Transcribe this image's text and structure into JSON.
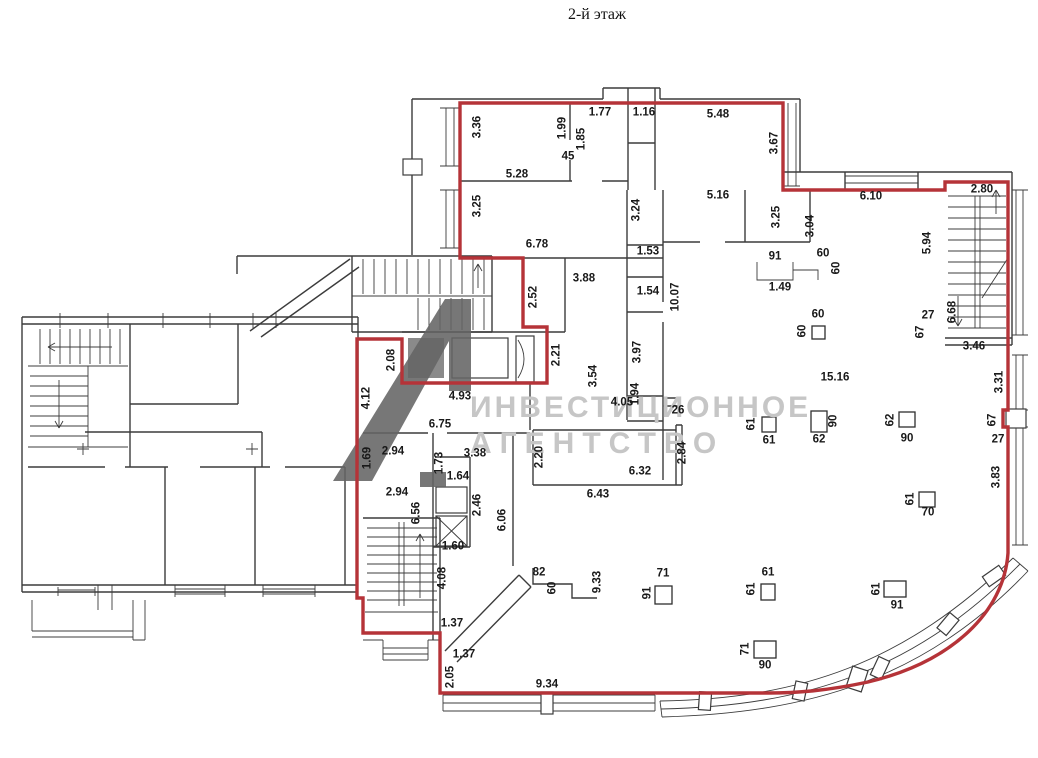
{
  "title": "2-й этаж",
  "watermark": {
    "line1": "ИНВЕСТИЦИОННОЕ",
    "line2": "АГЕНТСТВО"
  },
  "colors": {
    "outline_red": "#b53338",
    "watermark_gray": "#c6c6c6",
    "logo_gray": "#646464",
    "wall_gray": "#3c3c3c"
  },
  "plan": {
    "annotations": [
      {
        "t": "1.77",
        "x": 600,
        "y": 113
      },
      {
        "t": "1.16",
        "x": 644,
        "y": 113
      },
      {
        "t": "5.48",
        "x": 718,
        "y": 115
      },
      {
        "t": "45",
        "x": 568,
        "y": 157
      },
      {
        "t": "5.28",
        "x": 517,
        "y": 175
      },
      {
        "t": "6.10",
        "x": 871,
        "y": 197
      },
      {
        "t": "2.80",
        "x": 982,
        "y": 190
      },
      {
        "t": "5.16",
        "x": 718,
        "y": 196
      },
      {
        "t": "6.78",
        "x": 537,
        "y": 245
      },
      {
        "t": "1.53",
        "x": 648,
        "y": 252
      },
      {
        "t": "91",
        "x": 775,
        "y": 257
      },
      {
        "t": "60",
        "x": 823,
        "y": 254
      },
      {
        "t": "1.49",
        "x": 780,
        "y": 288
      },
      {
        "t": "1.54",
        "x": 648,
        "y": 292
      },
      {
        "t": "3.88",
        "x": 584,
        "y": 279
      },
      {
        "t": "60",
        "x": 818,
        "y": 315
      },
      {
        "t": "27",
        "x": 928,
        "y": 316
      },
      {
        "t": "3.46",
        "x": 974,
        "y": 347
      },
      {
        "t": "15.16",
        "x": 835,
        "y": 378
      },
      {
        "t": "4.93",
        "x": 460,
        "y": 397
      },
      {
        "t": "4.05",
        "x": 622,
        "y": 403
      },
      {
        "t": "26",
        "x": 678,
        "y": 411
      },
      {
        "t": "6.75",
        "x": 440,
        "y": 425
      },
      {
        "t": "61",
        "x": 769,
        "y": 441
      },
      {
        "t": "62",
        "x": 819,
        "y": 440
      },
      {
        "t": "90",
        "x": 907,
        "y": 439
      },
      {
        "t": "27",
        "x": 998,
        "y": 440
      },
      {
        "t": "2.94",
        "x": 393,
        "y": 452
      },
      {
        "t": "3.38",
        "x": 475,
        "y": 454
      },
      {
        "t": "1.64",
        "x": 458,
        "y": 477
      },
      {
        "t": "6.32",
        "x": 640,
        "y": 472
      },
      {
        "t": "6.43",
        "x": 598,
        "y": 495
      },
      {
        "t": "2.94",
        "x": 397,
        "y": 493
      },
      {
        "t": "70",
        "x": 928,
        "y": 513
      },
      {
        "t": "1.60",
        "x": 453,
        "y": 547
      },
      {
        "t": "82",
        "x": 539,
        "y": 573
      },
      {
        "t": "71",
        "x": 663,
        "y": 574
      },
      {
        "t": "61",
        "x": 768,
        "y": 573
      },
      {
        "t": "91",
        "x": 897,
        "y": 606
      },
      {
        "t": "1.37",
        "x": 452,
        "y": 624
      },
      {
        "t": "1.37",
        "x": 464,
        "y": 655
      },
      {
        "t": "90",
        "x": 765,
        "y": 666
      },
      {
        "t": "9.34",
        "x": 547,
        "y": 685
      },
      {
        "t": "3.36",
        "x": 478,
        "y": 127,
        "v": 1
      },
      {
        "t": "1.99",
        "x": 563,
        "y": 128,
        "v": 1
      },
      {
        "t": "1.85",
        "x": 582,
        "y": 139,
        "v": 1
      },
      {
        "t": "3.67",
        "x": 775,
        "y": 143,
        "v": 1
      },
      {
        "t": "3.25",
        "x": 478,
        "y": 206,
        "v": 1
      },
      {
        "t": "3.24",
        "x": 637,
        "y": 210,
        "v": 1
      },
      {
        "t": "3.25",
        "x": 777,
        "y": 217,
        "v": 1
      },
      {
        "t": "3.04",
        "x": 811,
        "y": 226,
        "v": 1
      },
      {
        "t": "5.94",
        "x": 928,
        "y": 243,
        "v": 1
      },
      {
        "t": "60",
        "x": 837,
        "y": 268,
        "v": 1
      },
      {
        "t": "2.52",
        "x": 534,
        "y": 297,
        "v": 1
      },
      {
        "t": "10.07",
        "x": 676,
        "y": 297,
        "v": 1
      },
      {
        "t": "6.68",
        "x": 953,
        "y": 312,
        "v": 1
      },
      {
        "t": "67",
        "x": 921,
        "y": 332,
        "v": 1
      },
      {
        "t": "60",
        "x": 803,
        "y": 331,
        "v": 1
      },
      {
        "t": "3.97",
        "x": 638,
        "y": 352,
        "v": 1
      },
      {
        "t": "2.21",
        "x": 557,
        "y": 355,
        "v": 1
      },
      {
        "t": "2.08",
        "x": 392,
        "y": 360,
        "v": 1
      },
      {
        "t": "3.54",
        "x": 594,
        "y": 376,
        "v": 1
      },
      {
        "t": "3.31",
        "x": 1000,
        "y": 382,
        "v": 1
      },
      {
        "t": "1.94",
        "x": 636,
        "y": 394,
        "v": 1
      },
      {
        "t": "4.12",
        "x": 367,
        "y": 398,
        "v": 1
      },
      {
        "t": "67",
        "x": 993,
        "y": 420,
        "v": 1
      },
      {
        "t": "62",
        "x": 891,
        "y": 420,
        "v": 1
      },
      {
        "t": "90",
        "x": 834,
        "y": 421,
        "v": 1
      },
      {
        "t": "61",
        "x": 752,
        "y": 424,
        "v": 1
      },
      {
        "t": "2.84",
        "x": 683,
        "y": 453,
        "v": 1
      },
      {
        "t": "2.20",
        "x": 540,
        "y": 457,
        "v": 1
      },
      {
        "t": "1.69",
        "x": 368,
        "y": 458,
        "v": 1
      },
      {
        "t": "1.73",
        "x": 440,
        "y": 463,
        "v": 1
      },
      {
        "t": "3.83",
        "x": 997,
        "y": 477,
        "v": 1
      },
      {
        "t": "61",
        "x": 911,
        "y": 499,
        "v": 1
      },
      {
        "t": "2.46",
        "x": 478,
        "y": 505,
        "v": 1
      },
      {
        "t": "6.56",
        "x": 417,
        "y": 513,
        "v": 1
      },
      {
        "t": "6.06",
        "x": 503,
        "y": 520,
        "v": 1
      },
      {
        "t": "4.08",
        "x": 443,
        "y": 578,
        "v": 1
      },
      {
        "t": "9.33",
        "x": 598,
        "y": 582,
        "v": 1
      },
      {
        "t": "60",
        "x": 553,
        "y": 588,
        "v": 1
      },
      {
        "t": "61",
        "x": 752,
        "y": 589,
        "v": 1
      },
      {
        "t": "61",
        "x": 877,
        "y": 589,
        "v": 1
      },
      {
        "t": "91",
        "x": 648,
        "y": 593,
        "v": 1
      },
      {
        "t": "71",
        "x": 746,
        "y": 649,
        "v": 1
      },
      {
        "t": "2.05",
        "x": 451,
        "y": 677,
        "v": 1
      }
    ],
    "columns": [
      {
        "x": 812,
        "y": 326,
        "w": 13,
        "h": 13
      },
      {
        "x": 762,
        "y": 417,
        "w": 14,
        "h": 15
      },
      {
        "x": 811,
        "y": 411,
        "w": 16,
        "h": 21
      },
      {
        "x": 899,
        "y": 412,
        "w": 16,
        "h": 15
      },
      {
        "x": 919,
        "y": 492,
        "w": 16,
        "h": 15
      },
      {
        "x": 655,
        "y": 586,
        "w": 17,
        "h": 18
      },
      {
        "x": 761,
        "y": 584,
        "w": 14,
        "h": 16
      },
      {
        "x": 884,
        "y": 581,
        "w": 22,
        "h": 16
      },
      {
        "x": 754,
        "y": 641,
        "w": 22,
        "h": 17
      }
    ]
  }
}
